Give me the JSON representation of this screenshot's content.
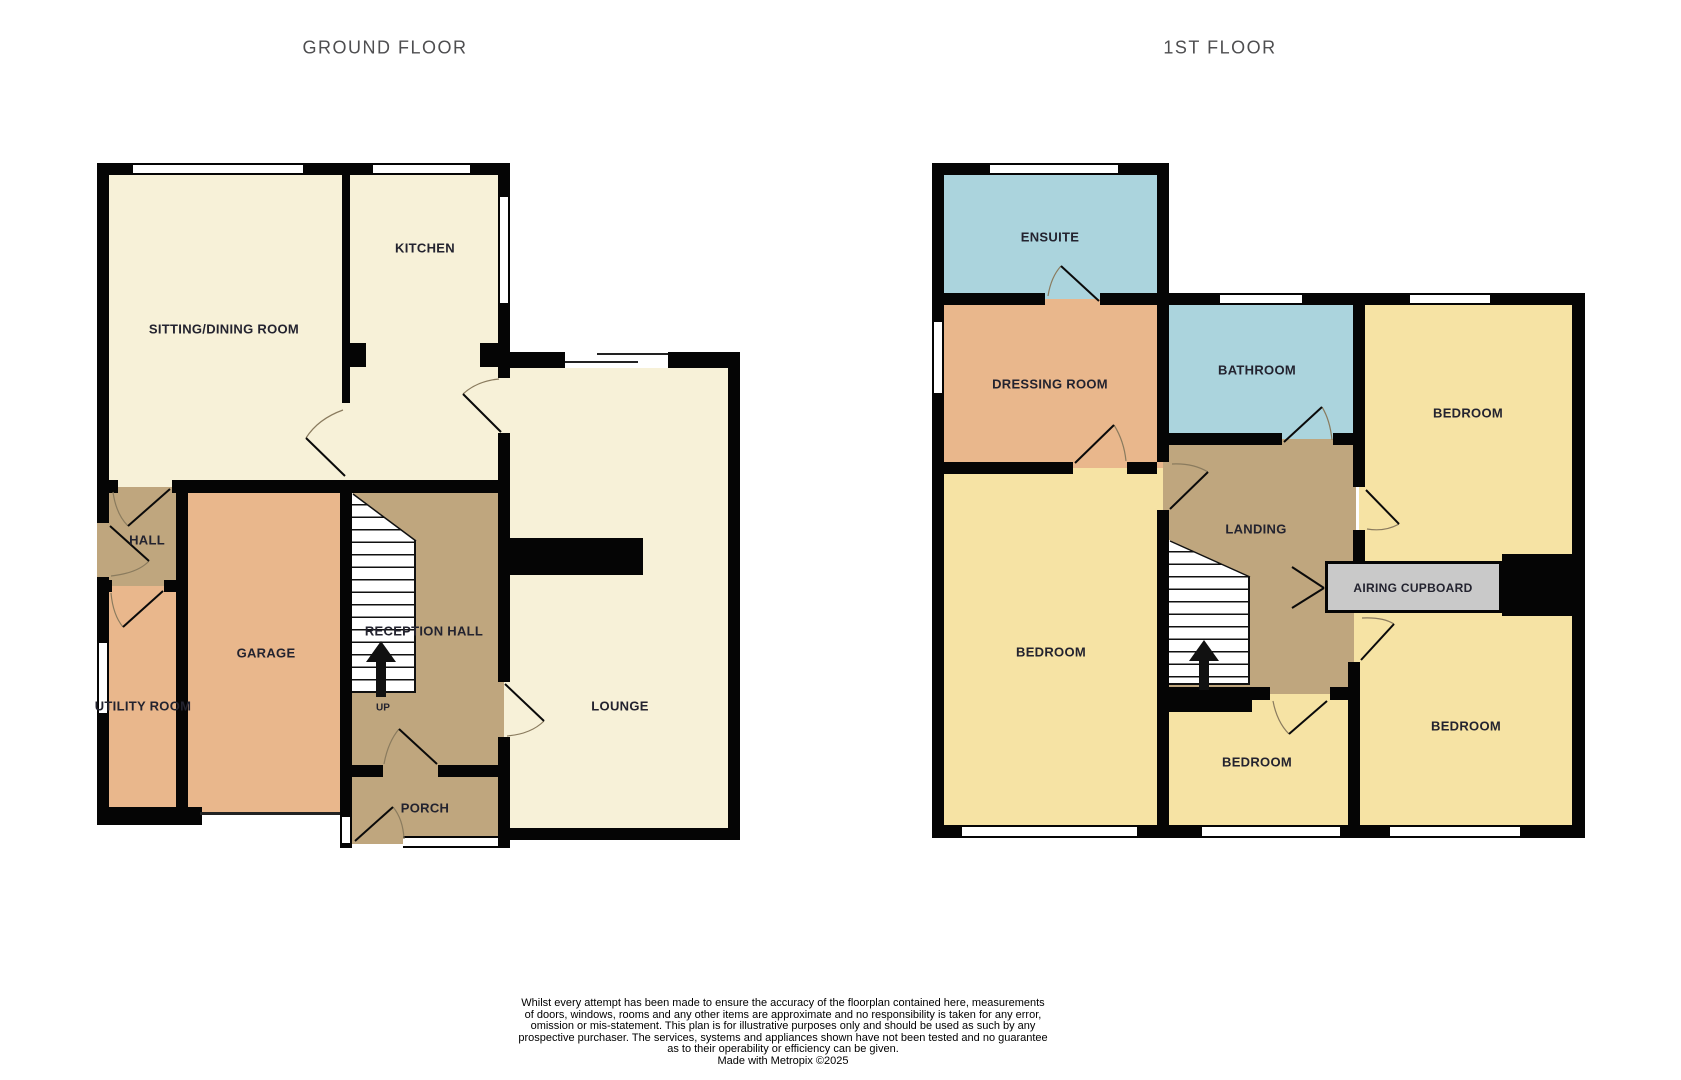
{
  "titles": {
    "ground_floor": "GROUND FLOOR",
    "first_floor": "1ST FLOOR"
  },
  "ground_floor": {
    "rooms": [
      {
        "id": "sitting-dining-room",
        "label": "SITTING/DINING ROOM"
      },
      {
        "id": "kitchen",
        "label": "KITCHEN"
      },
      {
        "id": "hall",
        "label": "HALL"
      },
      {
        "id": "utility-room",
        "label": "UTILITY ROOM"
      },
      {
        "id": "garage",
        "label": "GARAGE"
      },
      {
        "id": "reception-hall",
        "label": "RECEPTION HALL"
      },
      {
        "id": "lounge",
        "label": "LOUNGE"
      },
      {
        "id": "porch",
        "label": "PORCH"
      }
    ],
    "stairs": {
      "direction_label": "UP"
    }
  },
  "first_floor": {
    "rooms": [
      {
        "id": "ensuite",
        "label": "ENSUITE"
      },
      {
        "id": "dressing-room",
        "label": "DRESSING ROOM"
      },
      {
        "id": "bathroom",
        "label": "BATHROOM"
      },
      {
        "id": "bedroom-front",
        "label": "BEDROOM"
      },
      {
        "id": "landing",
        "label": "LANDING"
      },
      {
        "id": "airing-cupboard",
        "label": "AIRING CUPBOARD"
      },
      {
        "id": "bedroom-main",
        "label": "BEDROOM"
      },
      {
        "id": "bedroom-middle",
        "label": "BEDROOM"
      },
      {
        "id": "bedroom-rear",
        "label": "BEDROOM"
      }
    ]
  },
  "disclaimer": {
    "lines": [
      "Whilst every attempt has been made to ensure the accuracy of the floorplan contained here, measurements",
      "of doors, windows, rooms and any other items are approximate and no responsibility is taken for any error,",
      "omission or mis-statement. This plan is for illustrative purposes only and should be used as such by any",
      "prospective purchaser. The services, systems and appliances shown have not been tested and no guarantee",
      "as to their operability or efficiency can be given.",
      "Made with Metropix ©2025"
    ]
  },
  "colors": {
    "room_cream": "#f7f1d8",
    "room_tan": "#bfa67e",
    "room_salmon": "#e9b78c",
    "room_blue": "#abd4dd",
    "room_yellow": "#f6e3a4",
    "airing_cupboard_gray": "#c9c9c9",
    "wall_black": "#050505",
    "label_text": "#23232f",
    "title_text": "#4e4e50"
  }
}
